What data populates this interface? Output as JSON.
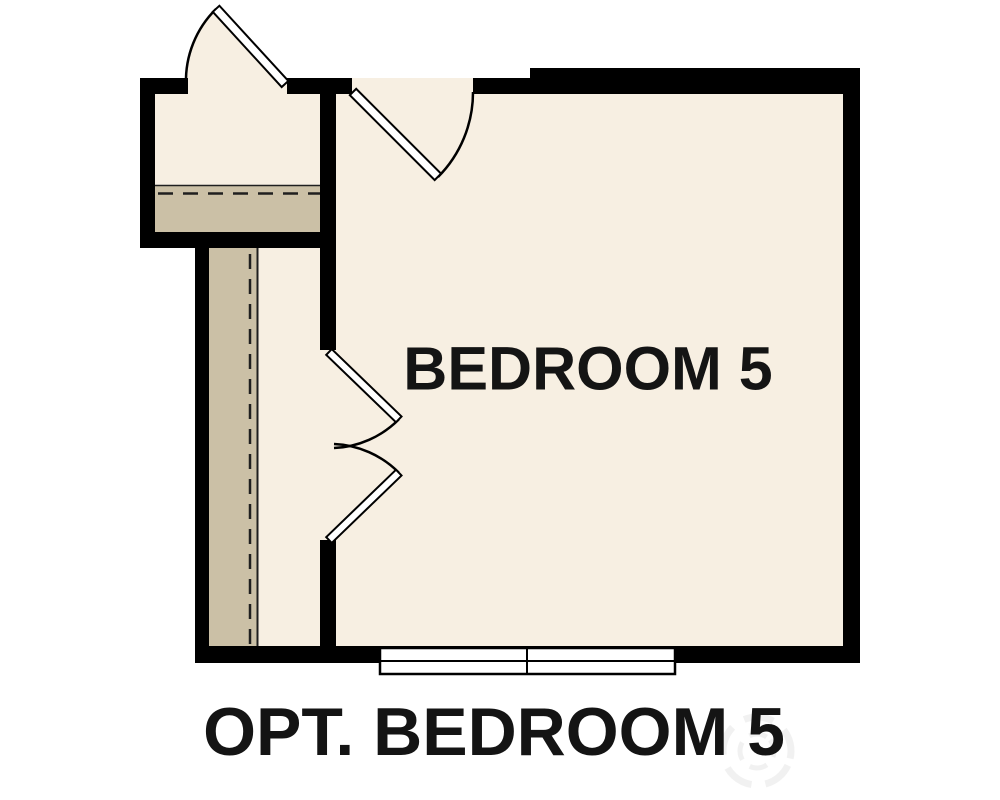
{
  "plan": {
    "room_label": "BEDROOM 5",
    "caption": "OPT. BEDROOM 5"
  },
  "colors": {
    "background": "#ffffff",
    "wall": "#000000",
    "floor": "#f7efe2",
    "stairs": "#cbc0a6",
    "door": "#ffffff",
    "line": "#1f1f1f",
    "text": "#141414",
    "watermark": "#8a8a8a"
  },
  "elements": {
    "doors": [
      {
        "name": "vestibule-exterior-door",
        "type": "single-swing",
        "swing": "outward-up-left"
      },
      {
        "name": "bedroom-entry-door",
        "type": "single-swing",
        "swing": "into-room"
      },
      {
        "name": "bedroom-double-doors",
        "type": "double-swing",
        "swing": "into-room"
      }
    ],
    "windows": [
      {
        "name": "bedroom-window",
        "panes": 2,
        "wall": "bottom"
      }
    ],
    "stairs": [
      {
        "name": "upper-landing",
        "orientation": "horizontal",
        "marking": "dashed-line"
      },
      {
        "name": "stair-run",
        "orientation": "vertical",
        "marking": "dashed-line"
      }
    ]
  }
}
